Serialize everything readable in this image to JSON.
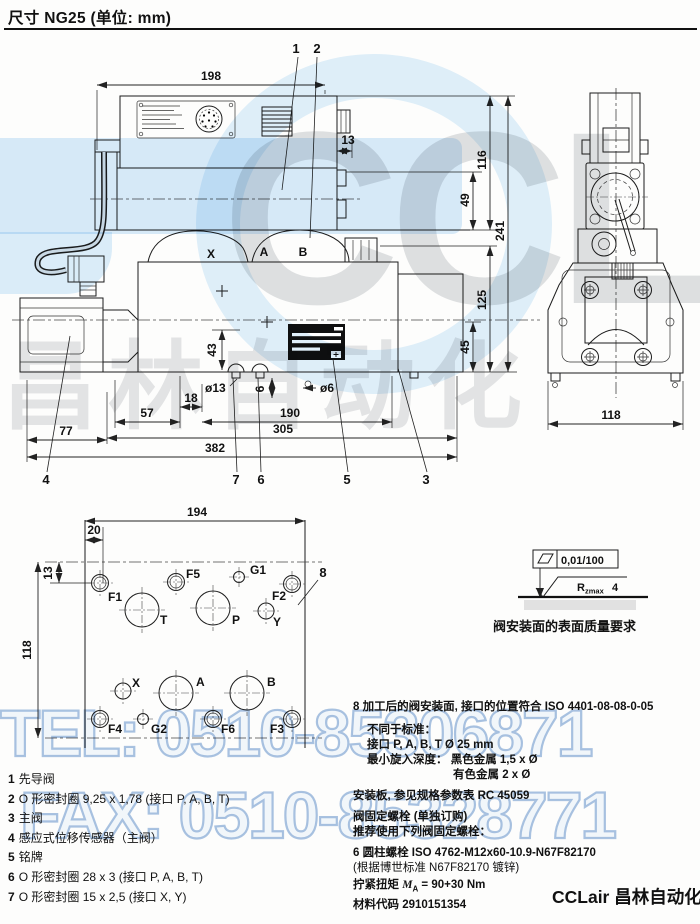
{
  "page": {
    "title": "尺寸 NG25 (单位: mm)",
    "footer_brand": "CCLair 昌林自动化"
  },
  "watermark": {
    "tel": "TEL: 0510-85306871",
    "fax": "FAX: 0510-85328771",
    "brand": "CCLair",
    "brand_cn": "昌林自动化"
  },
  "main_drawing": {
    "dims": {
      "w198": "198",
      "w13": "13",
      "h116": "116",
      "h49": "49",
      "h241": "241",
      "h125": "125",
      "h45": "45",
      "h43": "43",
      "dia13": "ø13",
      "w18": "18",
      "w57": "57",
      "w77": "77",
      "w190": "190",
      "w305": "305",
      "w382": "382",
      "h6": "6",
      "dia6": "ø6",
      "w118": "118"
    },
    "ports": {
      "x": "X",
      "a": "A",
      "b": "B"
    },
    "callouts": {
      "c1": "1",
      "c2": "2",
      "c3": "3",
      "c4": "4",
      "c5": "5",
      "c6": "6",
      "c7": "7"
    }
  },
  "plate_drawing": {
    "dims": {
      "w194": "194",
      "w20": "20",
      "h13": "13",
      "h118": "118"
    },
    "callout8": "8",
    "ports": [
      "F1",
      "F5",
      "G1",
      "F2",
      "T",
      "P",
      "Y",
      "X",
      "A",
      "B",
      "F4",
      "G2",
      "F6",
      "F3"
    ]
  },
  "surface_symbol": {
    "flatness": "0,01/100",
    "r": "R",
    "r_sub": "zmax",
    "r_val": "4",
    "caption": "阀安装面的表面质量要求"
  },
  "notes": {
    "item8_num": "8",
    "item8_text": "加工后的阀安装面, 接口的位置符合 ISO 4401-08-08-0-05",
    "line_standard": "不同于标准：",
    "line_ports": "接口 P, A, B, T Ø 25 mm",
    "line_depth": "最小旋入深度： 黑色金属 1,5 x Ø",
    "line_depth2": "有色金属 2 x Ø",
    "line_plate": "安装板, 参见规格参数表 RC 45059",
    "line_bolt1": "阀固定螺栓 (单独订购)",
    "line_bolt2": "推荐使用下列阀固定螺栓：",
    "line_bolt3": "6 圆柱螺栓 ISO 4762-M12x60-10.9-N67F82170",
    "line_bolt4": "(根据博世标准 N67F82170 镀锌)",
    "torque_prefix": "拧紧扭矩 ",
    "torque_m": "M",
    "torque_sub": "A",
    "torque_rest": " = 90+30 Nm",
    "mat_label": "材料代码 ",
    "mat_value": "2910151354"
  },
  "parts_list": [
    {
      "num": "1",
      "text": "先导阀"
    },
    {
      "num": "2",
      "text": "O 形密封圈 9,25 x 1,78 (接口 P, A, B, T)"
    },
    {
      "num": "3",
      "text": "主阀"
    },
    {
      "num": "4",
      "text": "感应式位移传感器（主阀）"
    },
    {
      "num": "5",
      "text": "铭牌"
    },
    {
      "num": "6",
      "text": "O 形密封圈 28 x 3 (接口 P, A, B, T)"
    },
    {
      "num": "7",
      "text": "O 形密封圈 15 x 2,5 (接口 X, Y)"
    }
  ]
}
